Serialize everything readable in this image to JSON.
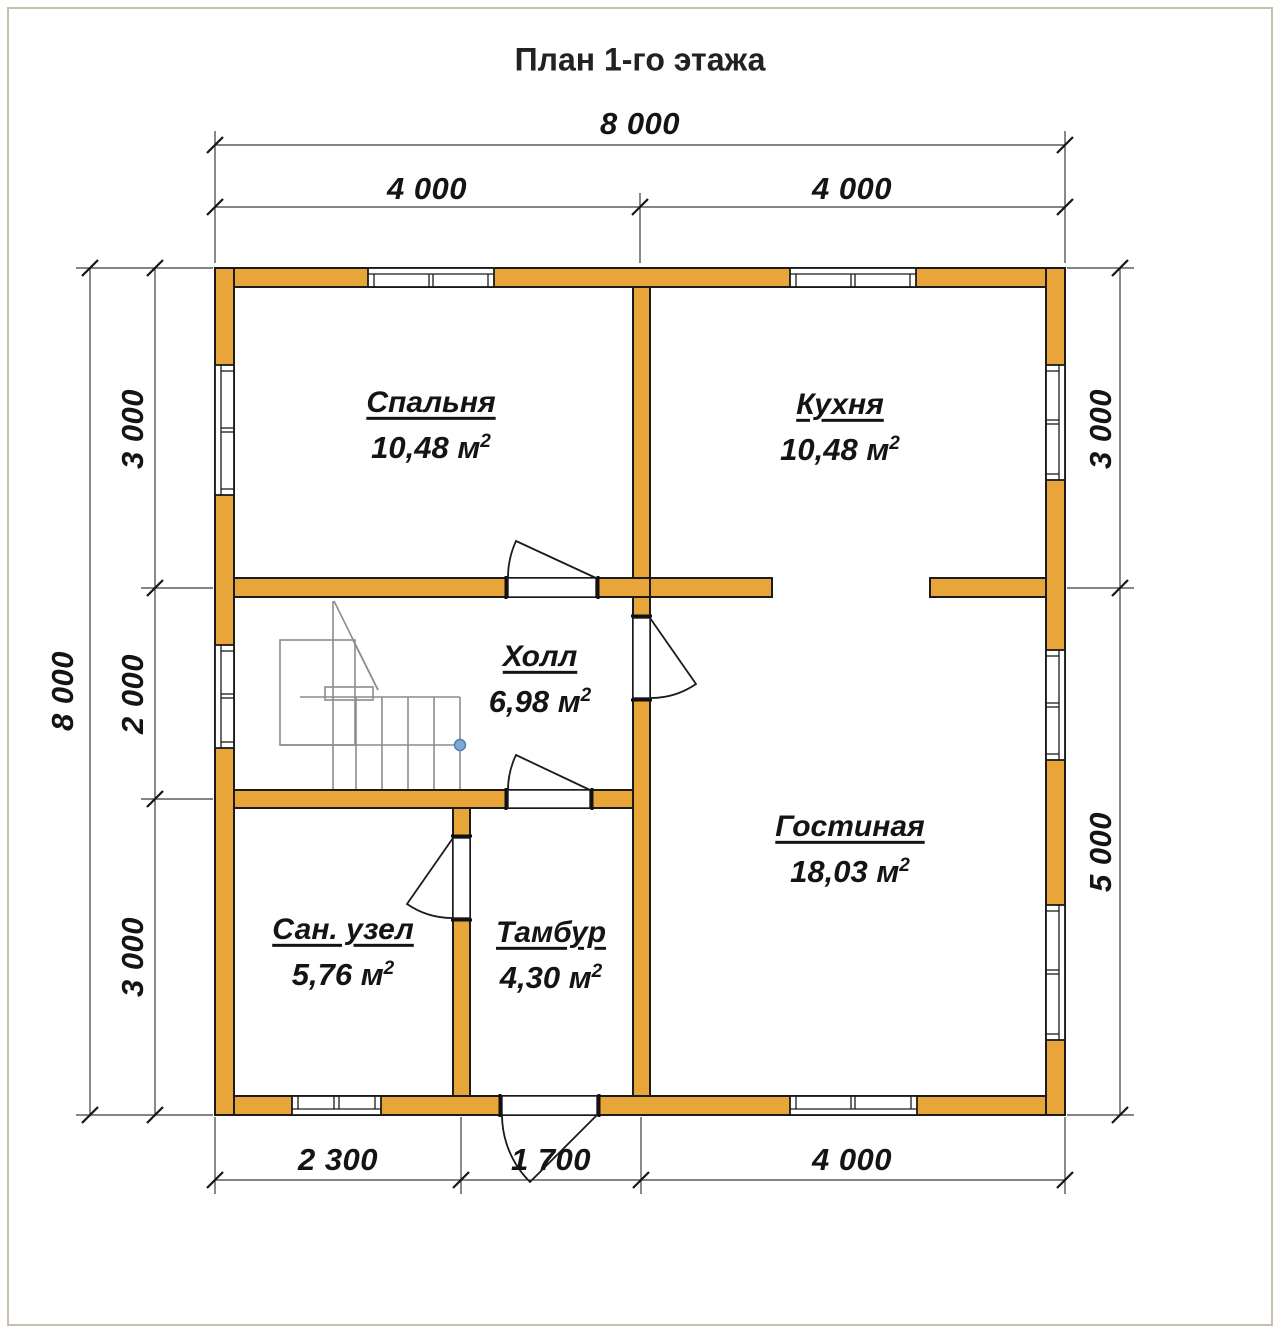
{
  "title": "План 1-го этажа",
  "dimensions": {
    "top_total": "8 000",
    "top_left": "4 000",
    "top_right": "4 000",
    "left_total": "8 000",
    "left_seg1": "3 000",
    "left_seg2": "2 000",
    "left_seg3": "3 000",
    "right_seg1": "3 000",
    "right_seg2": "5 000",
    "bottom_seg1": "2 300",
    "bottom_seg2": "1 700",
    "bottom_seg3": "4 000"
  },
  "rooms": {
    "bedroom": {
      "name": "Спальня",
      "area": "10,48 м",
      "sup": "2"
    },
    "kitchen": {
      "name": "Кухня",
      "area": "10,48 м",
      "sup": "2"
    },
    "hall": {
      "name": "Холл",
      "area": "6,98 м",
      "sup": "2"
    },
    "living": {
      "name": "Гостиная",
      "area": "18,03 м",
      "sup": "2"
    },
    "bathroom": {
      "name": "Сан. узел",
      "area": "5,76 м",
      "sup": "2"
    },
    "vestibule": {
      "name": "Тамбур",
      "area": "4,30 м",
      "sup": "2"
    }
  },
  "colors": {
    "wall": "#E8A63A",
    "wall_outline": "#1B1B1B",
    "stairs": "#8C8C8C",
    "dimension": "#3C3C3C",
    "frame": "#C8BEB2",
    "stair_dot": "#7FA8D9"
  }
}
